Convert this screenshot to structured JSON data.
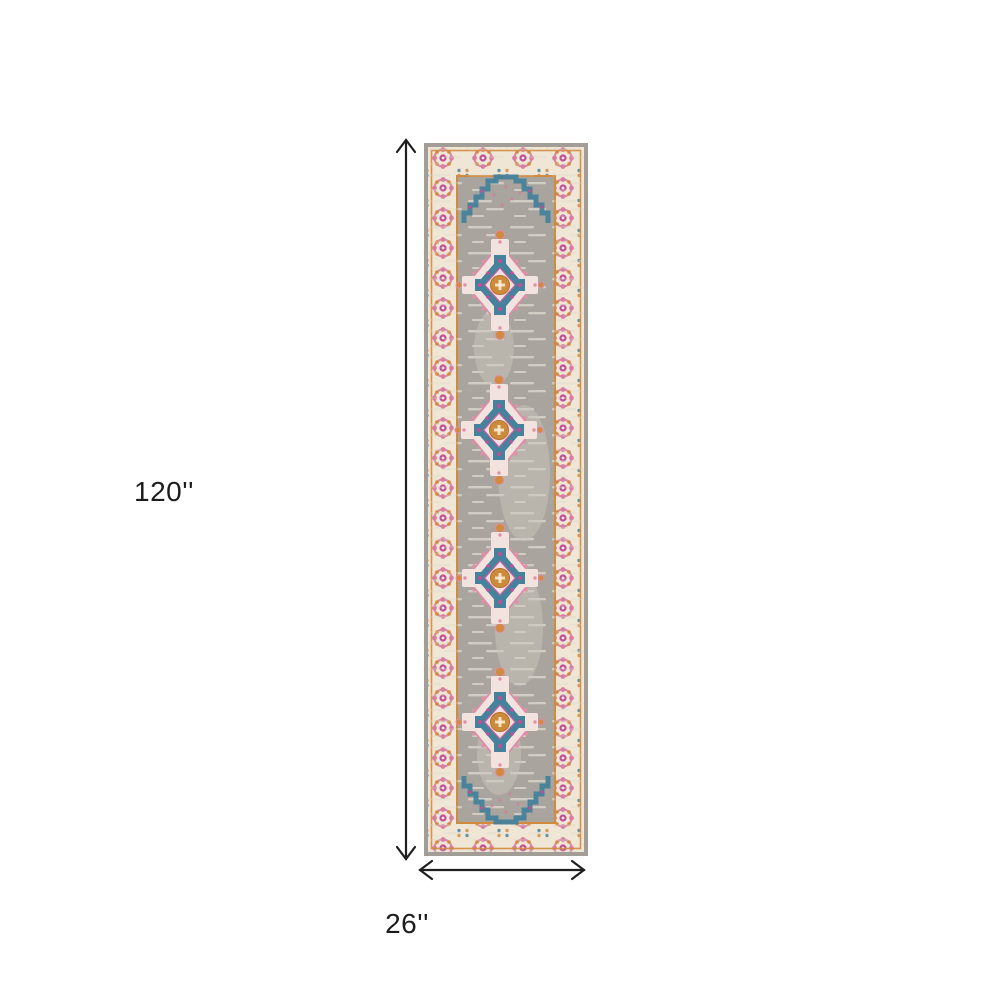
{
  "diagram": {
    "type": "rug-dimension-diagram",
    "subject": "Grey and pink Persian-style medallion runner rug shown with height and width dimension arrows",
    "dimensions": {
      "height_label": "120''",
      "width_label": "26''"
    },
    "arrow_color": "#1f1f1f"
  },
  "rug": {
    "medallion_count": 4,
    "colors": {
      "edge": "#a29d96",
      "field": "#a9a49d",
      "streak": "#d9d4ca",
      "patch": "#cdc8bf",
      "border_cream": "#f0e6d5",
      "guard_orange": "#d18a3e",
      "rosette_pink": "#d77ba0",
      "accent_magenta": "#c04f98",
      "teal": "#46829b",
      "gold": "#cb8b3a",
      "medallion_pale": "#f3e3df"
    }
  }
}
